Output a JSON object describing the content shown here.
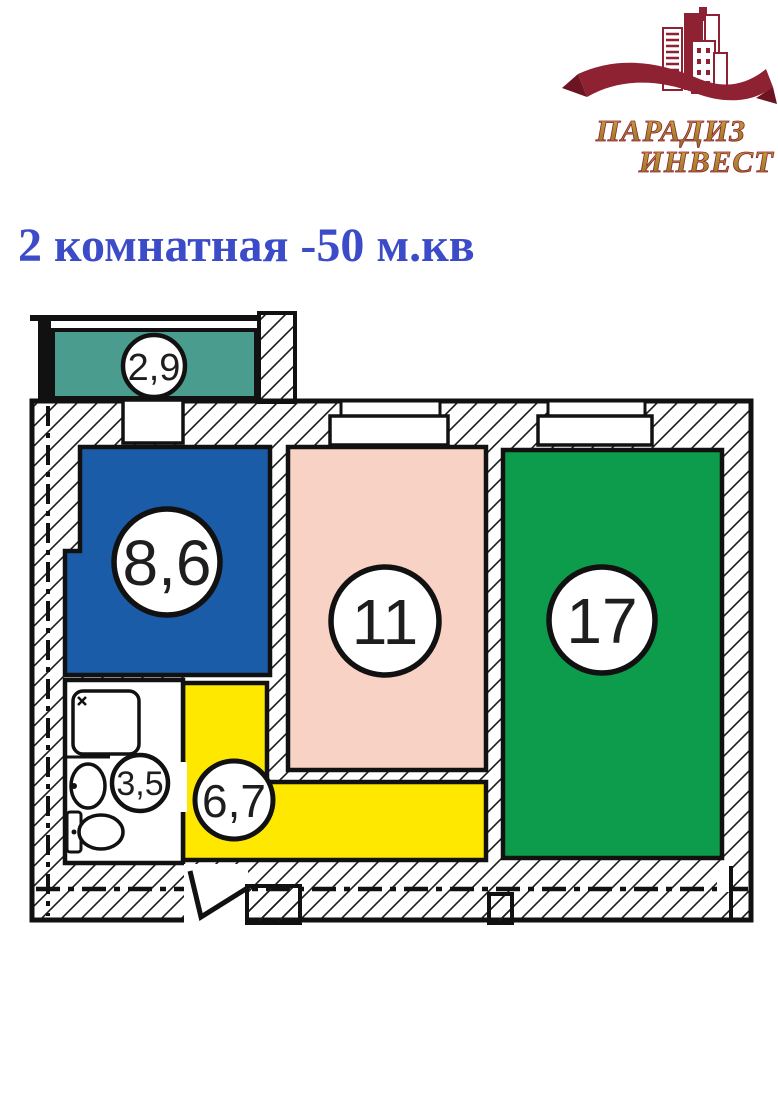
{
  "logo": {
    "line1": "ПАРАДИЗ",
    "line2": "ИНВЕСТ",
    "brand_color": "#8E2132",
    "text_color": "#B8872B"
  },
  "title": {
    "text": "2 комнатная -50 м.кв",
    "color": "#3C4BC8"
  },
  "floor_plan": {
    "outline_color": "#111111",
    "rooms": [
      {
        "id": "balcony",
        "label": "2,9",
        "color": "#4A9D8E"
      },
      {
        "id": "room-8-6",
        "label": "8,6",
        "color": "#1B5CA8"
      },
      {
        "id": "room-11",
        "label": "11",
        "color": "#F8D3C5"
      },
      {
        "id": "room-17",
        "label": "17",
        "color": "#0D9B4C"
      },
      {
        "id": "bathroom",
        "label": "3,5",
        "color": "#FFFFFF"
      },
      {
        "id": "corridor",
        "label": "6,7",
        "color": "#FFE800"
      }
    ]
  }
}
